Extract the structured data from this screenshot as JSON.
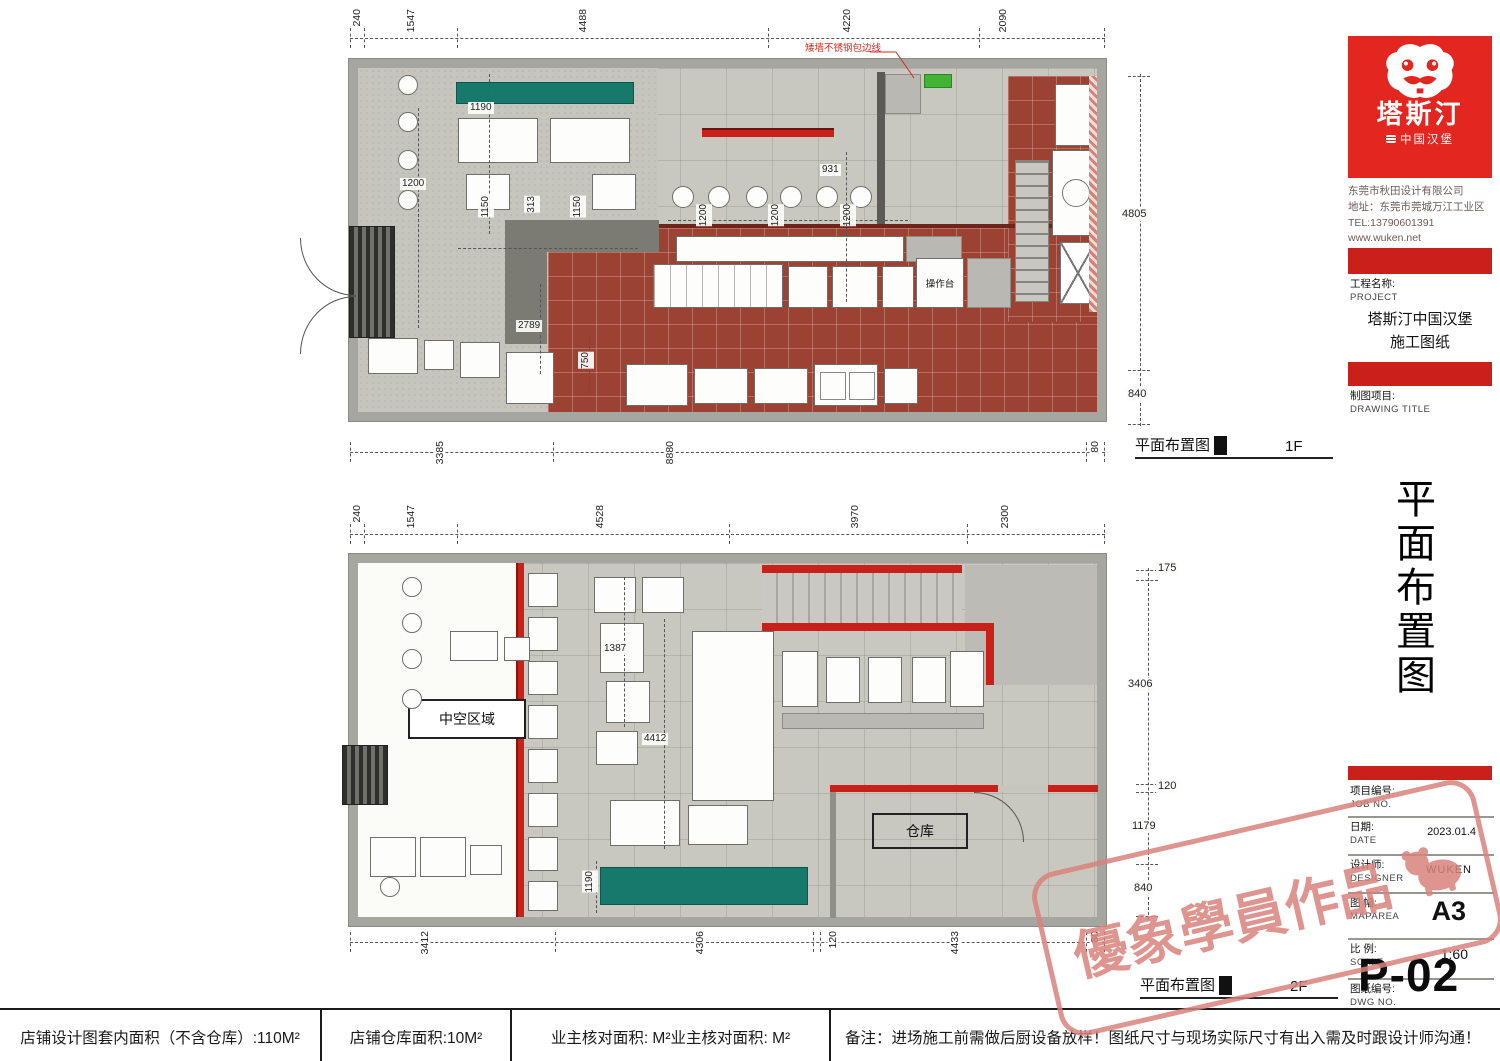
{
  "plan1f": {
    "caption": "平面布置图",
    "floor": "1F",
    "top_dims": [
      "240",
      "1547",
      "4488",
      "4220",
      "2090"
    ],
    "bottom_dims": [
      "3385",
      "8880",
      "80"
    ],
    "right_dims": [
      "4805",
      "840"
    ],
    "inner_dims": {
      "bench": "1190",
      "zone": "1200",
      "seat_left": "1150",
      "aisle": "313",
      "seat_right": "1150",
      "bar1": "1200",
      "bar2": "1200",
      "bar3": "1200",
      "pass": "931",
      "kitchen_depth": "2789",
      "drain": "750"
    },
    "labels": {
      "worktop": "操作台"
    },
    "annotation": "矮墙不锈钢包边线"
  },
  "plan2f": {
    "caption": "平面布置图",
    "floor": "2F",
    "top_dims": [
      "240",
      "1547",
      "4528",
      "3970",
      "2300"
    ],
    "bottom_dims": [
      "3412",
      "4306",
      "120",
      "4433",
      "80"
    ],
    "right_dims": [
      "175",
      "3406",
      "120",
      "1179",
      "840"
    ],
    "inner_dims": {
      "table_gap": "1387",
      "void_length": "4412",
      "bench": "1190"
    },
    "labels": {
      "void": "中空区域",
      "warehouse": "仓库"
    }
  },
  "titleblock": {
    "logo": {
      "brand": "塔斯汀",
      "subbrand": "中国汉堡"
    },
    "company": {
      "name": "东莞市秋田设计有限公司",
      "address": "地址：东莞市莞城万江工业区",
      "tel": "TEL:13790601391",
      "web": "www.wuken.net"
    },
    "project": {
      "label_cn": "工程名称:",
      "label_en": "PROJECT",
      "line1": "塔斯汀中国汉堡",
      "line2": "施工图纸"
    },
    "drawing": {
      "label_cn": "制图项目:",
      "label_en": "DRAWING TITLE"
    },
    "side_title": "平面布置图",
    "fields": [
      {
        "cn": "项目编号:",
        "en": "JOB NO.",
        "value": ""
      },
      {
        "cn": "日期:",
        "en": "DATE",
        "value": "2023.01.4"
      },
      {
        "cn": "设计师:",
        "en": "DESIGNER",
        "value": "WUKEN"
      },
      {
        "cn": "图 幅:",
        "en": "MAPAREA",
        "value": "A3"
      },
      {
        "cn": "比 例:",
        "en": "SCALE",
        "value": "1:60"
      },
      {
        "cn": "图纸编号:",
        "en": "DWG NO.",
        "value": ""
      }
    ],
    "sheet_no": "P-02"
  },
  "watermark": {
    "text": "優象學員作品"
  },
  "footer": {
    "cells": [
      "店铺设计图套内面积（不含仓库）:110M²",
      "店铺仓库面积:10M²",
      "业主核对面积: M²业主核对面积: M²",
      "备注：进场施工前需做后厨设备放样！图纸尺寸与现场实际尺寸有出入需及时跟设计师沟通！"
    ]
  }
}
